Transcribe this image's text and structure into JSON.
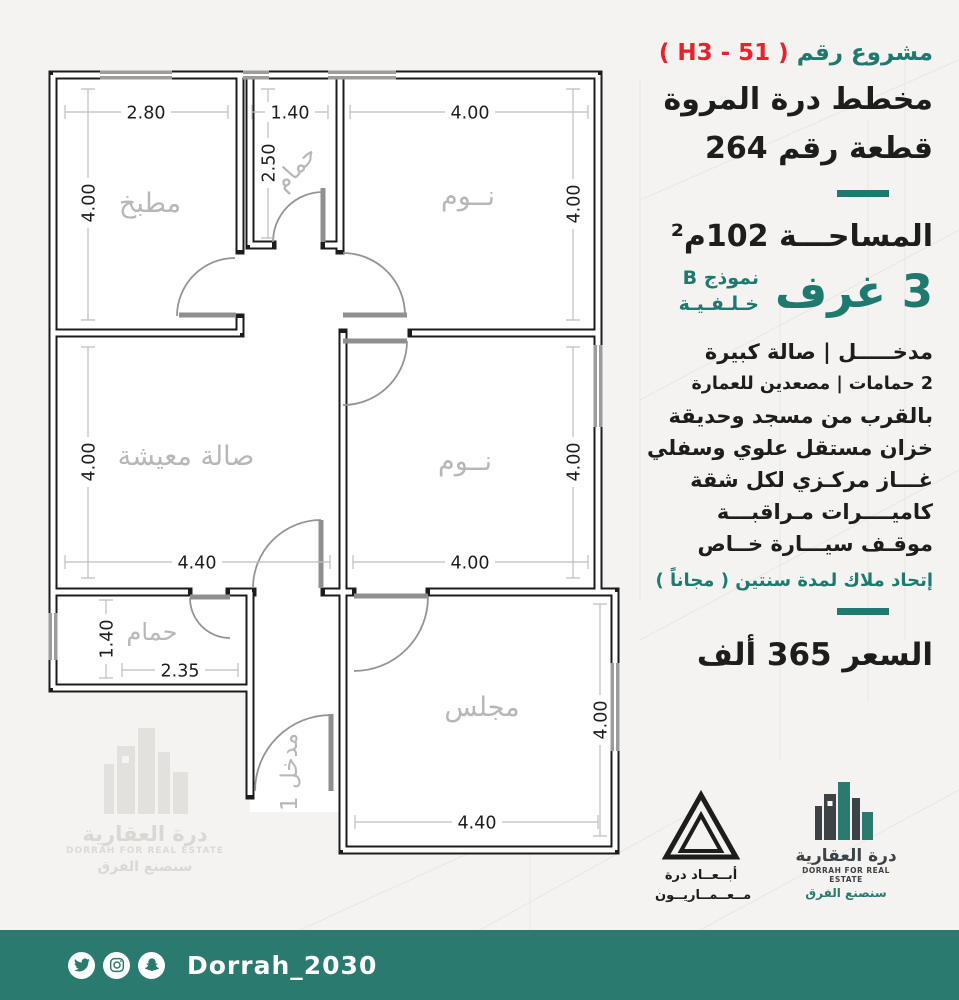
{
  "panel": {
    "project_prefix": "مشروع رقم",
    "project_code": "( H3 - 51 )",
    "title_line1": "مخطط درة المروة",
    "title_line2": "قطعة رقم 264",
    "area": "المساحـــة 102م²",
    "rooms_count": "3 غرف",
    "model_line1": "نموذج B",
    "model_line2": "خـلـفـيـة",
    "features": [
      "مدخـــــل   |   صالة كبيرة",
      "2 حمامات  |  مصعدين للعمارة",
      "بالقرب من مسجد وحديقة",
      "خزان مستقل علوي وسفلي",
      "غـــاز مركـزي لكل شقة",
      "كاميــــرات مـراقبـــة",
      "موقـف سيـــارة خــاص"
    ],
    "owners_union": "إتحاد ملاك لمدة سنتين ( مجاناً )",
    "price": "السعر  365  ألف"
  },
  "floor_plan": {
    "rooms": {
      "kitchen": {
        "label": "مطبخ",
        "w": "2.80",
        "h": "4.00"
      },
      "bath1": {
        "label": "حمام",
        "w": "1.40",
        "h": "2.50"
      },
      "bed1": {
        "label": "نــوم",
        "w": "4.00",
        "h": "4.00"
      },
      "living": {
        "label": "صالة معيشة",
        "w": "4.40",
        "h": "4.00"
      },
      "bed2": {
        "label": "نــوم",
        "w": "4.00",
        "h": "4.00"
      },
      "bath2": {
        "label": "حمام",
        "w": "2.35",
        "h": "1.40"
      },
      "majlis": {
        "label": "مجلس",
        "w": "4.40",
        "h": "4.00"
      },
      "entrance": {
        "label": "مدخل 1"
      }
    }
  },
  "logos": {
    "abaad": {
      "line1": "أبــعــاد درة",
      "line2": "مــعــمــاريــون"
    },
    "dorrah": {
      "name_ar": "درة العقارية",
      "name_en": "DORRAH FOR REAL ESTATE",
      "slogan": "سنصنع الفرق"
    }
  },
  "footer": {
    "handle": "Dorrah_2030"
  },
  "colors": {
    "teal": "#1e7a6f",
    "footer_teal": "#2a7a6f",
    "red": "#e8212b",
    "ink": "#1d1d1b"
  }
}
